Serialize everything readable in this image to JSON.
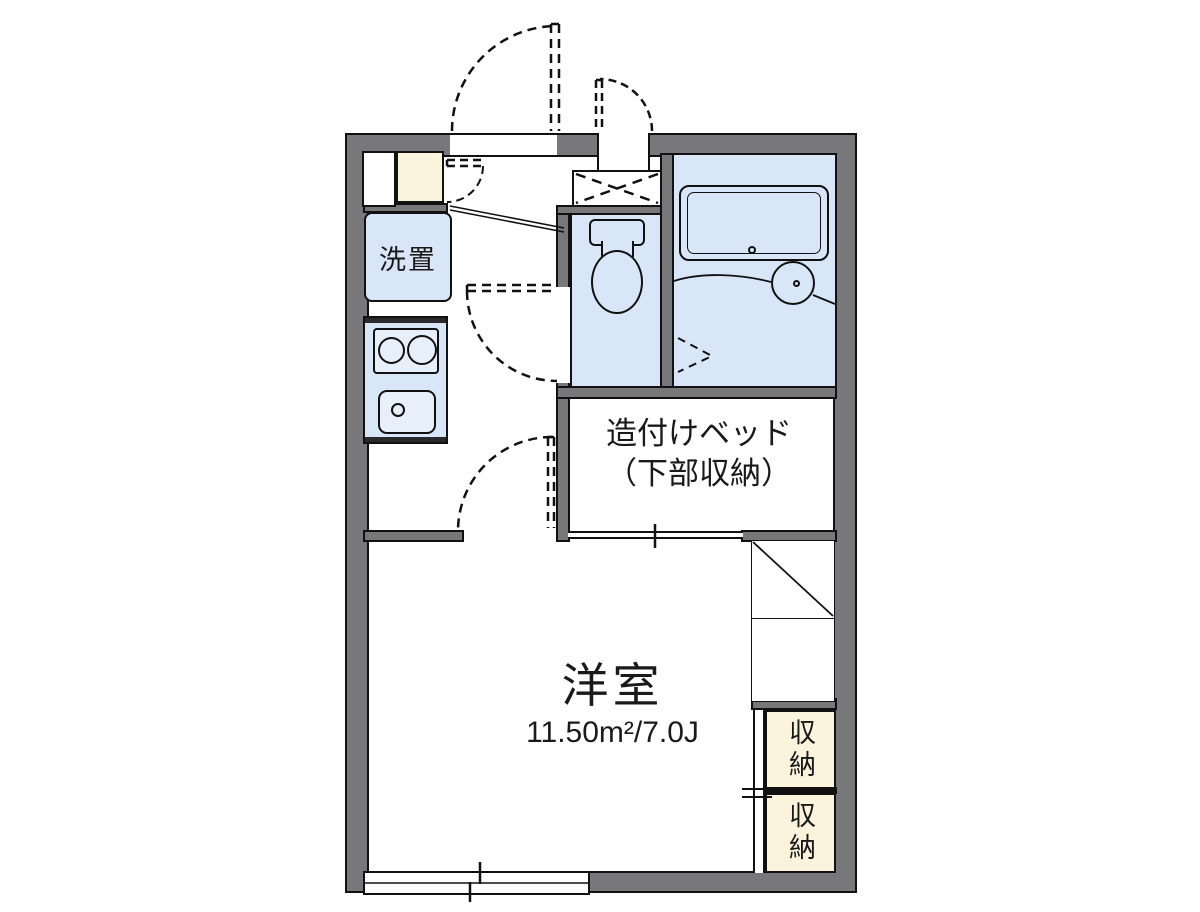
{
  "plan": {
    "type": "apartment-floor-plan",
    "labels": {
      "washer_space": "洗置",
      "built_in_bed_line1": "造付けベッド",
      "built_in_bed_line2": "（下部収納）",
      "main_room_name": "洋室",
      "main_room_area": "11.50m²/7.0J",
      "storage_top": "収納",
      "storage_bottom": "収納"
    },
    "colors": {
      "wall_gray": "#78787b",
      "water_area_blue": "#d9e6f7",
      "fixture_blue": "#e7effb",
      "storage_cream": "#fcf3dd",
      "line_black": "#111111"
    }
  }
}
